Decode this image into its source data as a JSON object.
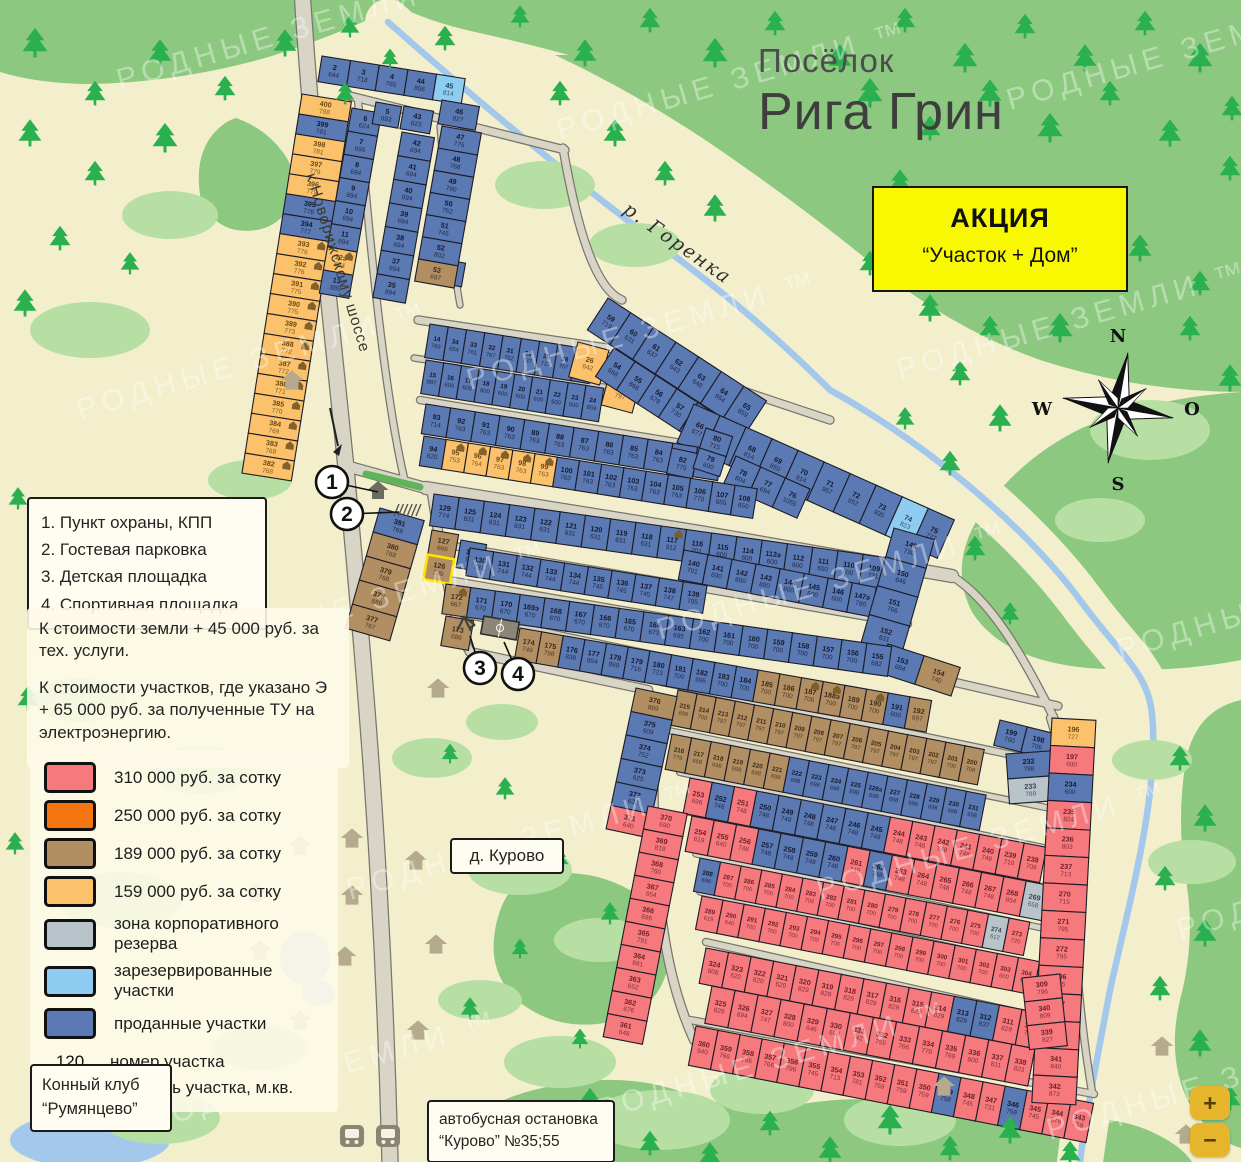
{
  "title": {
    "prefix": "Посёлок",
    "name": "Рига Грин"
  },
  "promo": {
    "line1": "АКЦИЯ",
    "line2": "“Участок + Дом”"
  },
  "watermark": "РОДНЫЕ ЗЕМЛИ ™",
  "compass": {
    "n": "N",
    "e": "O",
    "s": "S",
    "w": "W"
  },
  "map_labels": {
    "highway": "к Новорижскому шоссе",
    "river": "р. Горенка",
    "village": "д. Курово",
    "horse_club_1": "Конный клуб",
    "horse_club_2": "“Румянцево”",
    "bus_stop_1": "автобусная остановка",
    "bus_stop_2": "“Курово” №35;55"
  },
  "poi": [
    "1. Пункт охраны, КПП",
    "2. Гостевая парковка",
    "3. Детская площадка",
    "4. Спортивная площадка"
  ],
  "callout_numbers": [
    "1",
    "2",
    "3",
    "4"
  ],
  "notes": [
    "К стоимости земли + 45 000 руб. за тех. услуги.",
    "К стоимости участков, где указано Э + 65 000 руб. за полученные ТУ на электроэнергию."
  ],
  "price_legend": {
    "items": [
      {
        "color": "#f5797d",
        "label": "310 000 руб. за сотку"
      },
      {
        "color": "#f4750f",
        "label": "250 000 руб. за сотку"
      },
      {
        "color": "#b28e63",
        "label": "189 000 руб. за сотку"
      },
      {
        "color": "#fbc16b",
        "label": "159 000 руб. за сотку"
      },
      {
        "color": "#b9c4ca",
        "label": "зона корпоративного резерва"
      },
      {
        "color": "#8fccf1",
        "label": "зарезервированные участки"
      },
      {
        "color": "#5b79b2",
        "label": "проданные участки"
      }
    ],
    "sample": {
      "number": "120",
      "area": "1 200",
      "number_label": "номер участка",
      "area_label": "площадь участка, м.кв."
    }
  },
  "zoom_controls": {
    "in": "+",
    "out": "−"
  },
  "parcels": {
    "colors": {
      "B": {
        "fill": "#5b79b2",
        "text": "#141b33"
      },
      "L": {
        "fill": "#8fccf1",
        "text": "#1d4559"
      },
      "G": {
        "fill": "#b9c4ca",
        "text": "#39444b"
      },
      "R": {
        "fill": "#f5797d",
        "text": "#6e1f28"
      },
      "N": {
        "fill": "#f4750f",
        "text": "#5c2a00"
      },
      "T": {
        "fill": "#b28e63",
        "text": "#3d2c17"
      },
      "O": {
        "fill": "#fbc16b",
        "text": "#6b4a12"
      }
    },
    "blocks": [
      {
        "x": 302,
        "y": 94,
        "dir": "col",
        "cw": 50,
        "ch": 20.2,
        "angle": 9,
        "cells": [
          "400|788|O",
          "399|781|B",
          "398|781|O",
          "397|779|O",
          "396|779|O",
          "395|778|B",
          "394|777|B",
          "393|776|O|h",
          "392|776|O|h",
          "391|775|O|h",
          "390|775|O|h",
          "389|773|O|h",
          "388|772|O|h",
          "387|772|O|h",
          "386|771|O|h",
          "385|770|O|h",
          "384|769|O|h",
          "383|768|O|h",
          "382|768|O|h"
        ]
      },
      {
        "x": 322,
        "y": 56,
        "dir": "row",
        "cw": 29,
        "ch": 26,
        "angle": 9,
        "cells": [
          "2|644|B",
          "3|718|B",
          "4|765|B",
          "44|806|B",
          "45|814|L"
        ]
      },
      {
        "x": 352,
        "y": 108,
        "dir": "col",
        "cw": 30,
        "ch": 23.5,
        "angle": 10,
        "cells": [
          "6|624|B",
          "7|695|B",
          "8|694|B",
          "9|694|B",
          "10|694|B",
          "11|694|B",
          "12э|694|O|h",
          "13|889|B"
        ]
      },
      {
        "x": 376,
        "y": 102,
        "dir": "col",
        "cw": 26,
        "ch": 22,
        "angle": 10,
        "cells": [
          "5|693|B"
        ]
      },
      {
        "x": 404,
        "y": 106,
        "dir": "col",
        "cw": 30,
        "ch": 23,
        "angle": 10,
        "cells": [
          "43|623|B"
        ]
      },
      {
        "x": 402,
        "y": 132,
        "dir": "col",
        "cw": 33,
        "ch": 24,
        "angle": 10,
        "cells": [
          "42|694|B",
          "41|694|B",
          "40|694|B",
          "39|694|B",
          "38|694|B",
          "37|694|B",
          "35|894|B"
        ]
      },
      {
        "x": 436,
        "y": 258,
        "dir": "col",
        "cw": 30,
        "ch": 24,
        "angle": 10,
        "cells": [
          "36|889|B"
        ]
      },
      {
        "x": 442,
        "y": 100,
        "dir": "col",
        "cw": 38,
        "ch": 24,
        "angle": 10,
        "cells": [
          "46|827|B"
        ]
      },
      {
        "x": 442,
        "y": 126,
        "dir": "col",
        "cw": 40,
        "ch": 22.5,
        "angle": 10,
        "cells": [
          "47|775|B",
          "48|768|B",
          "49|760|B",
          "50|752|B",
          "51|745|B",
          "52|802|B",
          "53|697|T"
        ]
      },
      {
        "x": 430,
        "y": 324,
        "dir": "row",
        "cw": 18.5,
        "ch": 34,
        "angle": 9,
        "cells": [
          "14|769|B",
          "34|654|B",
          "33|761|B",
          "32|767|B",
          "31|752|B",
          "30|737|B",
          "29|723|B",
          "28|707|B",
          "27|629|B"
        ]
      },
      {
        "x": 578,
        "y": 342,
        "dir": "row",
        "cw": 32,
        "ch": 36,
        "angle": 15,
        "cells": [
          "26|842|O"
        ]
      },
      {
        "x": 610,
        "y": 372,
        "dir": "row",
        "cw": 32,
        "ch": 34,
        "angle": 15,
        "cells": [
          "25|797|O"
        ]
      },
      {
        "x": 426,
        "y": 360,
        "dir": "row",
        "cw": 18,
        "ch": 34,
        "angle": 9,
        "cells": [
          "15|887|B",
          "16|600|B",
          "17|600|B",
          "18|600|B",
          "19|600|B",
          "20|600|B",
          "21|600|B",
          "22|600|B",
          "23|600|B",
          "24|859|B"
        ]
      },
      {
        "x": 608,
        "y": 298,
        "dir": "row",
        "cw": 27,
        "ch": 38,
        "angle": 33,
        "cells": [
          "59|719|B",
          "60|631|B",
          "61|637|B",
          "62|643|B",
          "63|648|B",
          "64|654|B",
          "65|659|B"
        ]
      },
      {
        "x": 614,
        "y": 348,
        "dir": "row",
        "cw": 25,
        "ch": 34,
        "angle": 33,
        "cells": [
          "54|668|B",
          "55|666|B",
          "56|679|B",
          "57|730|B",
          "58|719|B"
        ]
      },
      {
        "x": 694,
        "y": 404,
        "dir": "row",
        "cw": 28.5,
        "ch": 42,
        "angle": 24,
        "cells": [
          "66|677|B",
          "67|684|B",
          "68|814|B",
          "69|850|B",
          "70|914|B",
          "71|967|B",
          "72|952|B",
          "73|935|B",
          "74|823|L",
          "75|777|B"
        ]
      },
      {
        "x": 426,
        "y": 404,
        "dir": "row",
        "cw": 25,
        "ch": 30,
        "angle": 9,
        "cells": [
          "93|714|B",
          "92|763|B",
          "91|763|B",
          "90|763|B",
          "89|763|B",
          "88|763|B",
          "87|763|B",
          "86|763|B",
          "85|763|B",
          "84|763|B",
          "83|763|B",
          "81|770|B"
        ]
      },
      {
        "x": 672,
        "y": 448,
        "dir": "row",
        "cw": 26,
        "ch": 26,
        "angle": 12,
        "cells": [
          "82|775|B"
        ]
      },
      {
        "x": 706,
        "y": 428,
        "dir": "col",
        "cw": 28,
        "ch": 21,
        "angle": 18,
        "cells": [
          "80|715|B",
          "79|600|B"
        ]
      },
      {
        "x": 736,
        "y": 456,
        "dir": "row",
        "cw": 27,
        "ch": 32,
        "angle": 24,
        "cells": [
          "78|804|B",
          "77|694|B",
          "76|1055|B"
        ]
      },
      {
        "x": 424,
        "y": 436,
        "dir": "row",
        "cw": 22.5,
        "ch": 30,
        "angle": 9,
        "cells": [
          "94|620|B",
          "95|753|O|h",
          "96|764|O|h",
          "97|763|O|h",
          "98|763|O|h",
          "99|763|O|h",
          "100|763|B",
          "101|763|B",
          "102|763|B",
          "103|763|B",
          "104|763|B",
          "105|763|B",
          "106|770|B",
          "107|655|B",
          "108|650|B"
        ]
      },
      {
        "x": 434,
        "y": 494,
        "dir": "row",
        "cw": 25.5,
        "ch": 32,
        "angle": 8,
        "cells": [
          "129|774|B",
          "125|631|B",
          "124|631|B",
          "123|631|B",
          "122|631|B",
          "121|631|B",
          "120|631|B",
          "119|631|B",
          "118|631|B",
          "117|912|B|h",
          "116|701|B",
          "115|600|B",
          "114|600|B",
          "113э|600|B",
          "112|600|B",
          "111|600|B",
          "110|600|B",
          "109|731|B"
        ]
      },
      {
        "x": 432,
        "y": 530,
        "dir": "col",
        "cw": 27,
        "ch": 25,
        "angle": 10,
        "cells": [
          "127|666|T",
          "126|799|T|y"
        ]
      },
      {
        "x": 461,
        "y": 540,
        "dir": "col",
        "cw": 26,
        "ch": 28,
        "angle": 10,
        "cells": [
          "128|942|B"
        ]
      },
      {
        "x": 470,
        "y": 548,
        "dir": "row",
        "cw": 24,
        "ch": 28,
        "angle": 9,
        "cells": [
          "130|731|B",
          "131|744|B",
          "132|744|B",
          "133|744|B",
          "134|744|B",
          "135|745|B",
          "136|745|B",
          "137|745|B",
          "138|747|B",
          "139|705|B"
        ]
      },
      {
        "x": 684,
        "y": 550,
        "dir": "row",
        "cw": 24.5,
        "ch": 30,
        "angle": 11,
        "cells": [
          "140|701|B",
          "141|600|B",
          "142|800|B",
          "143|800|B",
          "144|800|B",
          "145|600|B",
          "146|600|B",
          "147э|780|B",
          "148|789|B"
        ]
      },
      {
        "x": 894,
        "y": 528,
        "dir": "col",
        "cw": 42,
        "ch": 30,
        "angle": 16,
        "cells": [
          "149|730|B",
          "150|646|B",
          "151|766|B",
          "152|831|B"
        ]
      },
      {
        "x": 888,
        "y": 644,
        "dir": "row",
        "cw": 38,
        "ch": 30,
        "angle": 18,
        "cells": [
          "153|684|B",
          "154|740|T"
        ]
      },
      {
        "x": 446,
        "y": 584,
        "dir": "row",
        "cw": 25,
        "ch": 30,
        "angle": 8,
        "cells": [
          "172|667|T|h",
          "171|670|B",
          "170|670|B",
          "169э|670|B",
          "168|670|B",
          "167|670|B",
          "166|670|B",
          "165|670|B",
          "164|673|B",
          "163|695|B",
          "162|700|B",
          "161|700|B",
          "160|700|B",
          "159|700|B",
          "158|700|B",
          "157|700|B",
          "156|700|B",
          "155|682|B"
        ]
      },
      {
        "x": 446,
        "y": 616,
        "dir": "row",
        "cw": 28,
        "ch": 30,
        "angle": 10,
        "cells": [
          "173|686|T"
        ]
      },
      {
        "x": 520,
        "y": 628,
        "dir": "row",
        "cw": 22,
        "ch": 32,
        "angle": 10,
        "cells": [
          "174|749|T",
          "175|798|T",
          "176|838|B",
          "177|854|B",
          "178|869|B",
          "179|716|B",
          "180|723|B",
          "181|700|B",
          "182|695|B",
          "183|700|B",
          "184|700|B",
          "185|700|T",
          "186|700|T",
          "187|700|T|h",
          "188э|700|T|h",
          "189|700|T",
          "190|700|T|h",
          "191|600|B",
          "192|697|T"
        ]
      },
      {
        "x": 1000,
        "y": 720,
        "dir": "row",
        "cw": 28,
        "ch": 26,
        "angle": 14,
        "cells": [
          "199|700|B",
          "198|706|B"
        ]
      },
      {
        "x": 678,
        "y": 690,
        "dir": "row",
        "cw": 19.5,
        "ch": 36,
        "angle": 11,
        "cells": [
          "215|699|T",
          "214|700|T",
          "213|797|T",
          "212|797|T",
          "211|797|T",
          "210|797|T",
          "209|797|T",
          "208|797|T",
          "207|797|T",
          "206|787|T",
          "205|797|T",
          "204|797|T",
          "203|797|T",
          "202|797|T",
          "201|700|T",
          "200|706|T"
        ]
      },
      {
        "x": 672,
        "y": 734,
        "dir": "row",
        "cw": 20,
        "ch": 36,
        "angle": 11,
        "cells": [
          "216|779|T",
          "217|668|T",
          "218|698|T",
          "219|698|T",
          "220|698|T",
          "221|698|T",
          "222|698|B",
          "223|698|B",
          "224|698|B",
          "225|698|B",
          "226э|698|B",
          "227|698|B",
          "228|698|B",
          "229|698|B",
          "230|698|B",
          "231|698|B"
        ]
      },
      {
        "x": 1006,
        "y": 754,
        "dir": "col",
        "cw": 44,
        "ch": 25,
        "angle": -4,
        "cells": [
          "232|798|B",
          "233|789|G"
        ]
      },
      {
        "x": 636,
        "y": 688,
        "dir": "col",
        "cw": 42,
        "ch": 24,
        "angle": 12,
        "cells": [
          "376|889|T",
          "375|609|B",
          "374|752|B",
          "373|625|B",
          "372|632|B",
          "371|640|R"
        ]
      },
      {
        "x": 690,
        "y": 778,
        "dir": "row",
        "cw": 22.7,
        "ch": 36,
        "angle": 11,
        "cells": [
          "253|696|R",
          "252|748|B",
          "251|748|R",
          "250|748|B",
          "249|748|B",
          "248|748|B",
          "247|748|B",
          "246|748|B",
          "245|748|B",
          "244|748|R",
          "243|748|R",
          "242|748|R",
          "241|748|R",
          "240|748|R",
          "239|710|R",
          "238|709|R"
        ]
      },
      {
        "x": 692,
        "y": 816,
        "dir": "row",
        "cw": 22.7,
        "ch": 36,
        "angle": 11,
        "cells": [
          "254|619|R",
          "255|640|R",
          "256|748|R",
          "257|748|B",
          "258|748|B",
          "259|748|B",
          "260|748|B",
          "261|748|R",
          "262|748|B",
          "263|748|R",
          "264|748|R",
          "265|748|R",
          "266|748|R",
          "267|748|R",
          "268|854|R",
          "269|658|G"
        ]
      },
      {
        "x": 700,
        "y": 858,
        "dir": "row",
        "cw": 21,
        "ch": 34,
        "angle": 11,
        "cells": [
          "288|696|B",
          "287|700|R",
          "286|700|R",
          "285|700|R",
          "284|700|R",
          "283|700|R",
          "282|700|R",
          "281|700|R",
          "280|700|R",
          "279|700|R",
          "278|700|R",
          "277|700|R",
          "276|700|R",
          "275|700|R",
          "274|612|G",
          "273|720|R"
        ]
      },
      {
        "x": 702,
        "y": 896,
        "dir": "row",
        "cw": 21.5,
        "ch": 34,
        "angle": 11,
        "cells": [
          "289|619|R",
          "290|640|R",
          "291|700|R",
          "292|700|R",
          "293|700|R",
          "294|700|R",
          "295|700|R",
          "296|700|R",
          "297|700|R",
          "298|700|R",
          "299|700|R",
          "300|700|R",
          "301|700|R",
          "302|700|R",
          "303|600|R",
          "304|600|R",
          "305|651|G"
        ]
      },
      {
        "x": 706,
        "y": 948,
        "dir": "row",
        "cw": 23,
        "ch": 36,
        "angle": 11,
        "cells": [
          "324|808|R",
          "323|620|R",
          "322|620|R",
          "321|620|R",
          "320|829|R",
          "319|829|R",
          "318|829|R",
          "317|829|R",
          "316|829|R",
          "315|829|R",
          "314|829|R",
          "313|829|B",
          "312|837|B",
          "311|829|R",
          "310|753|R"
        ]
      },
      {
        "x": 712,
        "y": 986,
        "dir": "row",
        "cw": 23.5,
        "ch": 38,
        "angle": 11,
        "cells": [
          "325|829|R",
          "326|694|R",
          "327|747|R",
          "328|800|R",
          "329|646|R",
          "330|698|R",
          "331|742|R",
          "332|755|R",
          "333|766|R",
          "334|778|R",
          "335|789|R",
          "336|800|R",
          "337|811|R",
          "338|823|R"
        ]
      },
      {
        "x": 696,
        "y": 1026,
        "dir": "row",
        "cw": 22.5,
        "ch": 40,
        "angle": 11,
        "cells": [
          "360|940|R",
          "359|766|R",
          "358|766|R",
          "357|766|R",
          "356|796|R",
          "355|745|R",
          "354|713|R",
          "353|781|R",
          "352|759|R",
          "351|759|R",
          "350|759|R",
          "349|759|B",
          "348|745|R",
          "347|731|R",
          "346|759|B",
          "345|745|R",
          "344|678|R",
          "343|759|R"
        ]
      },
      {
        "x": 648,
        "y": 806,
        "dir": "col",
        "cw": 40,
        "ch": 23.5,
        "angle": 11,
        "cells": [
          "370|690|R",
          "369|819|R",
          "368|760|R",
          "367|654|R",
          "366|696|R",
          "365|791|R",
          "364|691|R",
          "363|652|R",
          "362|676|R",
          "361|648|R"
        ]
      },
      {
        "x": 1052,
        "y": 718,
        "dir": "col",
        "cw": 44,
        "ch": 27.5,
        "angle": 3,
        "cells": [
          "196|727|O",
          "197|600|R",
          "234|600|B",
          "235|824|R",
          "236|803|R",
          "237|713|R",
          "270|715|R",
          "271|795|R",
          "272|795|R",
          "306|795|R",
          "307|808|R",
          "308|840|R",
          "341|840|R",
          "342|873|R"
        ]
      },
      {
        "x": 1022,
        "y": 978,
        "dir": "col",
        "cw": 38,
        "ch": 24,
        "angle": -6,
        "cells": [
          "309|796|R",
          "340|809|R",
          "339|827|R"
        ]
      },
      {
        "x": 380,
        "y": 508,
        "dir": "col",
        "cw": 46,
        "ch": 25,
        "angle": 16,
        "cells": [
          "381|769|B",
          "380|768|T",
          "379|768|T",
          "378|889|T",
          "377|767|T"
        ]
      }
    ]
  }
}
